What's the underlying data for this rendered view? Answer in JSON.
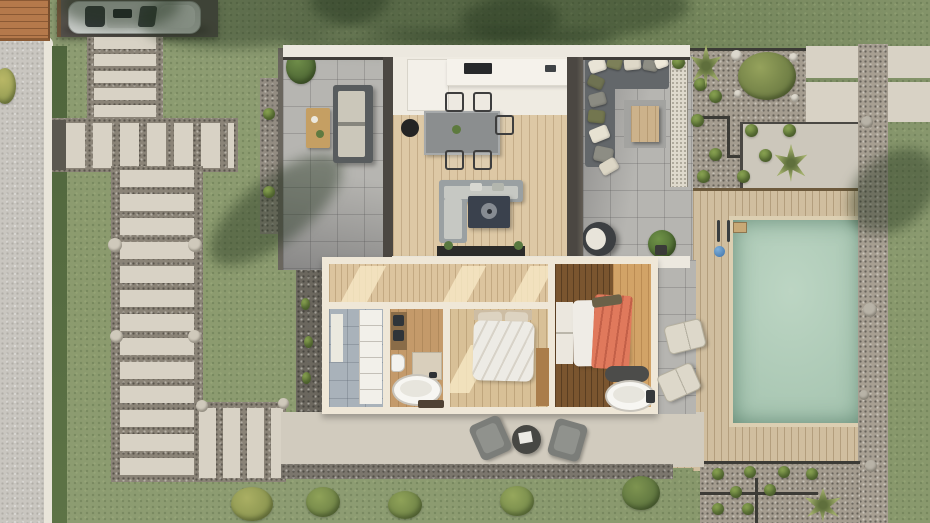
{
  "canvas": {
    "width": 930,
    "height": 523
  },
  "palette": {
    "grass": "#8d9c72",
    "road": "#c9c6c0",
    "curb": "#e9e5da",
    "hedge": "#55683f",
    "deckWood": "#b5794b",
    "driveway": "#55514b",
    "carBody": "#bcc0bc",
    "slab": "#d8d2c5",
    "gravel": "#8a8377",
    "gravelWarm": "#a49c8f",
    "paver": "#b6b5b1",
    "roofWhite": "#ece8df",
    "beam": "#4b4742",
    "floorWood": "#ddc8a5",
    "floorWhite": "#efebe2",
    "wallCream": "#efe7d7",
    "sofaGray": "#9aa0a2",
    "tableNavy": "#3a414d",
    "deck": "#d0be9f",
    "poolWater": "#a8c6b2",
    "poolFloat": "#3c70a8",
    "coral": "#e0795c",
    "tileBlue": "#a9b2ba",
    "terrace": "#d1cbbe",
    "shadow": "rgba(32,48,26,0.42)"
  },
  "scenery": {
    "groups": [
      {
        "layer": "shadow-layer",
        "class": "shadow-blob",
        "name": "tree-shadow",
        "items": [
          {
            "x": 60,
            "y": -20,
            "w": 120,
            "h": 48
          },
          {
            "x": 140,
            "y": -26,
            "w": 250,
            "h": 72,
            "rot": -6
          },
          {
            "x": 310,
            "y": -22,
            "w": 250,
            "h": 64,
            "rot": 4
          },
          {
            "x": 460,
            "y": -16,
            "w": 230,
            "h": 58,
            "rot": -4
          },
          {
            "x": 283,
            "y": 30,
            "w": 335,
            "h": 22,
            "rot": -1
          },
          {
            "x": 196,
            "y": 178,
            "w": 160,
            "h": 64,
            "rot": -38,
            "name": "house-shadow-southwest"
          },
          {
            "x": 843,
            "y": 155,
            "w": 100,
            "h": 72,
            "rot": -42,
            "name": "shadow-east"
          }
        ]
      },
      {
        "layer": "plant-layer",
        "class": "shrub",
        "name": "shrub",
        "items": [
          {
            "x": 672,
            "y": 56,
            "w": 13,
            "h": 13
          },
          {
            "x": 694,
            "y": 78,
            "w": 13,
            "h": 13
          },
          {
            "x": 709,
            "y": 90,
            "w": 13,
            "h": 13
          },
          {
            "x": 691,
            "y": 114,
            "w": 13,
            "h": 13
          },
          {
            "x": 745,
            "y": 124,
            "w": 13,
            "h": 13
          },
          {
            "x": 783,
            "y": 124,
            "w": 13,
            "h": 13
          },
          {
            "x": 709,
            "y": 148,
            "w": 13,
            "h": 13
          },
          {
            "x": 759,
            "y": 149,
            "w": 13,
            "h": 13
          },
          {
            "x": 697,
            "y": 170,
            "w": 13,
            "h": 13
          },
          {
            "x": 737,
            "y": 170,
            "w": 13,
            "h": 13
          },
          {
            "x": 712,
            "y": 468,
            "w": 12,
            "h": 12
          },
          {
            "x": 744,
            "y": 466,
            "w": 12,
            "h": 12
          },
          {
            "x": 778,
            "y": 466,
            "w": 12,
            "h": 12
          },
          {
            "x": 806,
            "y": 468,
            "w": 12,
            "h": 12
          },
          {
            "x": 730,
            "y": 486,
            "w": 12,
            "h": 12
          },
          {
            "x": 764,
            "y": 484,
            "w": 12,
            "h": 12
          },
          {
            "x": 712,
            "y": 503,
            "w": 12,
            "h": 12
          },
          {
            "x": 742,
            "y": 503,
            "w": 12,
            "h": 12
          },
          {
            "x": 263,
            "y": 108,
            "w": 12,
            "h": 12
          },
          {
            "x": 263,
            "y": 186,
            "w": 12,
            "h": 12
          },
          {
            "x": 301,
            "y": 298,
            "w": 9,
            "h": 12,
            "name": "grass-tuft"
          },
          {
            "x": 304,
            "y": 336,
            "w": 9,
            "h": 12,
            "name": "grass-tuft"
          },
          {
            "x": 302,
            "y": 372,
            "w": 9,
            "h": 12,
            "name": "grass-tuft"
          },
          {
            "x": 738,
            "y": 52,
            "w": 58,
            "h": 48,
            "c1": "#95a25c",
            "c2": "#5c6c39",
            "name": "large-bush"
          },
          {
            "x": 286,
            "y": 50,
            "w": 30,
            "h": 34,
            "c1": "#6f8d49",
            "c2": "#3f562b",
            "name": "patio-plant"
          },
          {
            "x": 648,
            "y": 230,
            "w": 28,
            "h": 28,
            "c1": "#6f9247",
            "c2": "#3f5a2b",
            "name": "potted-tree"
          },
          {
            "x": -6,
            "y": 68,
            "w": 22,
            "h": 36,
            "c1": "#b9b766",
            "c2": "#8b964f",
            "name": "roadside-bush"
          },
          {
            "x": 231,
            "y": 487,
            "w": 42,
            "h": 34,
            "c1": "#aaaf63",
            "c2": "#7d8a48",
            "name": "lawn-bush"
          },
          {
            "x": 306,
            "y": 487,
            "w": 34,
            "h": 30,
            "c1": "#8fa258",
            "c2": "#62763f",
            "name": "lawn-bush"
          },
          {
            "x": 388,
            "y": 491,
            "w": 34,
            "h": 28,
            "c1": "#8fa258",
            "c2": "#62763f",
            "name": "lawn-bush"
          },
          {
            "x": 500,
            "y": 486,
            "w": 34,
            "h": 30,
            "c1": "#96a75c",
            "c2": "#687e43",
            "name": "lawn-bush"
          },
          {
            "x": 622,
            "y": 476,
            "w": 38,
            "h": 34,
            "c1": "#7e9450",
            "c2": "#4f6637",
            "name": "lawn-bush"
          }
        ]
      },
      {
        "layer": "plant-layer",
        "class": "palm",
        "name": "palm-plant",
        "items": [
          {
            "x": 690,
            "y": 44,
            "w": 32,
            "h": 44
          },
          {
            "x": 774,
            "y": 144,
            "w": 34,
            "h": 38
          },
          {
            "x": 804,
            "y": 488,
            "w": 38,
            "h": 34
          }
        ]
      },
      {
        "layer": "plant-layer",
        "class": "stone",
        "name": "stone",
        "items": [
          {
            "x": 731,
            "y": 50,
            "w": 11,
            "h": 11,
            "c": "#dcd8cd"
          },
          {
            "x": 789,
            "y": 53,
            "w": 9,
            "h": 9,
            "c": "#dcd8cd"
          },
          {
            "x": 734,
            "y": 90,
            "w": 8,
            "h": 8,
            "c": "#dcd8cd"
          },
          {
            "x": 791,
            "y": 94,
            "w": 8,
            "h": 8,
            "c": "#dcd8cd"
          },
          {
            "x": 861,
            "y": 116,
            "w": 12,
            "h": 12,
            "c": "#b8b3a7"
          },
          {
            "x": 863,
            "y": 303,
            "w": 14,
            "h": 14,
            "c": "#b8b3a7"
          },
          {
            "x": 859,
            "y": 390,
            "w": 10,
            "h": 10,
            "c": "#b8b3a7"
          },
          {
            "x": 865,
            "y": 460,
            "w": 12,
            "h": 12,
            "c": "#b8b3a7"
          },
          {
            "x": 108,
            "y": 238,
            "w": 14,
            "h": 14,
            "c": "#cfc9bb"
          },
          {
            "x": 188,
            "y": 238,
            "w": 14,
            "h": 14,
            "c": "#cfc9bb"
          },
          {
            "x": 110,
            "y": 330,
            "w": 13,
            "h": 13,
            "c": "#cfc9bb"
          },
          {
            "x": 188,
            "y": 330,
            "w": 13,
            "h": 13,
            "c": "#cfc9bb"
          },
          {
            "x": 196,
            "y": 400,
            "w": 12,
            "h": 12,
            "c": "#cfc9bb"
          },
          {
            "x": 278,
            "y": 398,
            "w": 11,
            "h": 11,
            "c": "#cfc9bb"
          }
        ]
      },
      {
        "layer": "cushion-layer",
        "class": "cushion",
        "name": "lounge-cushion",
        "items": [
          {
            "x": 589,
            "y": 59,
            "w": 17,
            "h": 13,
            "rot": -18,
            "c": "#e9e4d6"
          },
          {
            "x": 607,
            "y": 57,
            "w": 15,
            "h": 12,
            "rot": 15,
            "c": "#7d8059"
          },
          {
            "x": 624,
            "y": 58,
            "w": 17,
            "h": 12,
            "rot": -6,
            "c": "#ded8c8"
          },
          {
            "x": 643,
            "y": 60,
            "w": 15,
            "h": 11,
            "rot": 10,
            "c": "#8e8e85"
          },
          {
            "x": 655,
            "y": 57,
            "w": 13,
            "h": 11,
            "rot": -20,
            "c": "#efeadb"
          },
          {
            "x": 588,
            "y": 76,
            "w": 16,
            "h": 12,
            "rot": 24,
            "c": "#6f7252"
          },
          {
            "x": 589,
            "y": 93,
            "w": 17,
            "h": 13,
            "rot": -15,
            "c": "#8b8b82"
          },
          {
            "x": 588,
            "y": 110,
            "w": 17,
            "h": 13,
            "rot": 6,
            "c": "#73764f"
          },
          {
            "x": 590,
            "y": 127,
            "w": 19,
            "h": 14,
            "rot": -22,
            "c": "#e7e2d2"
          },
          {
            "x": 594,
            "y": 147,
            "w": 19,
            "h": 15,
            "rot": 12,
            "c": "#8d8d84"
          },
          {
            "x": 600,
            "y": 160,
            "w": 18,
            "h": 13,
            "rot": -30,
            "c": "#dcd6c5"
          }
        ]
      },
      {
        "layer": "chair-layer",
        "class": "wf-chair",
        "name": "dining-chair",
        "items": [
          {
            "x": 445,
            "y": 92,
            "w": 15,
            "h": 16
          },
          {
            "x": 473,
            "y": 92,
            "w": 15,
            "h": 16
          },
          {
            "x": 445,
            "y": 150,
            "w": 15,
            "h": 16
          },
          {
            "x": 473,
            "y": 150,
            "w": 15,
            "h": 16
          },
          {
            "x": 495,
            "y": 115,
            "w": 15,
            "h": 16
          }
        ]
      },
      {
        "layer": "skylight-layer",
        "class": "sky",
        "name": "skylight-patch",
        "items": [
          {
            "x": 350,
            "y": 266,
            "w": 26,
            "h": 38
          },
          {
            "x": 452,
            "y": 266,
            "w": 24,
            "h": 38
          },
          {
            "x": 520,
            "y": 266,
            "w": 24,
            "h": 38
          },
          {
            "x": 458,
            "y": 345,
            "w": 24,
            "h": 48
          }
        ]
      }
    ]
  }
}
